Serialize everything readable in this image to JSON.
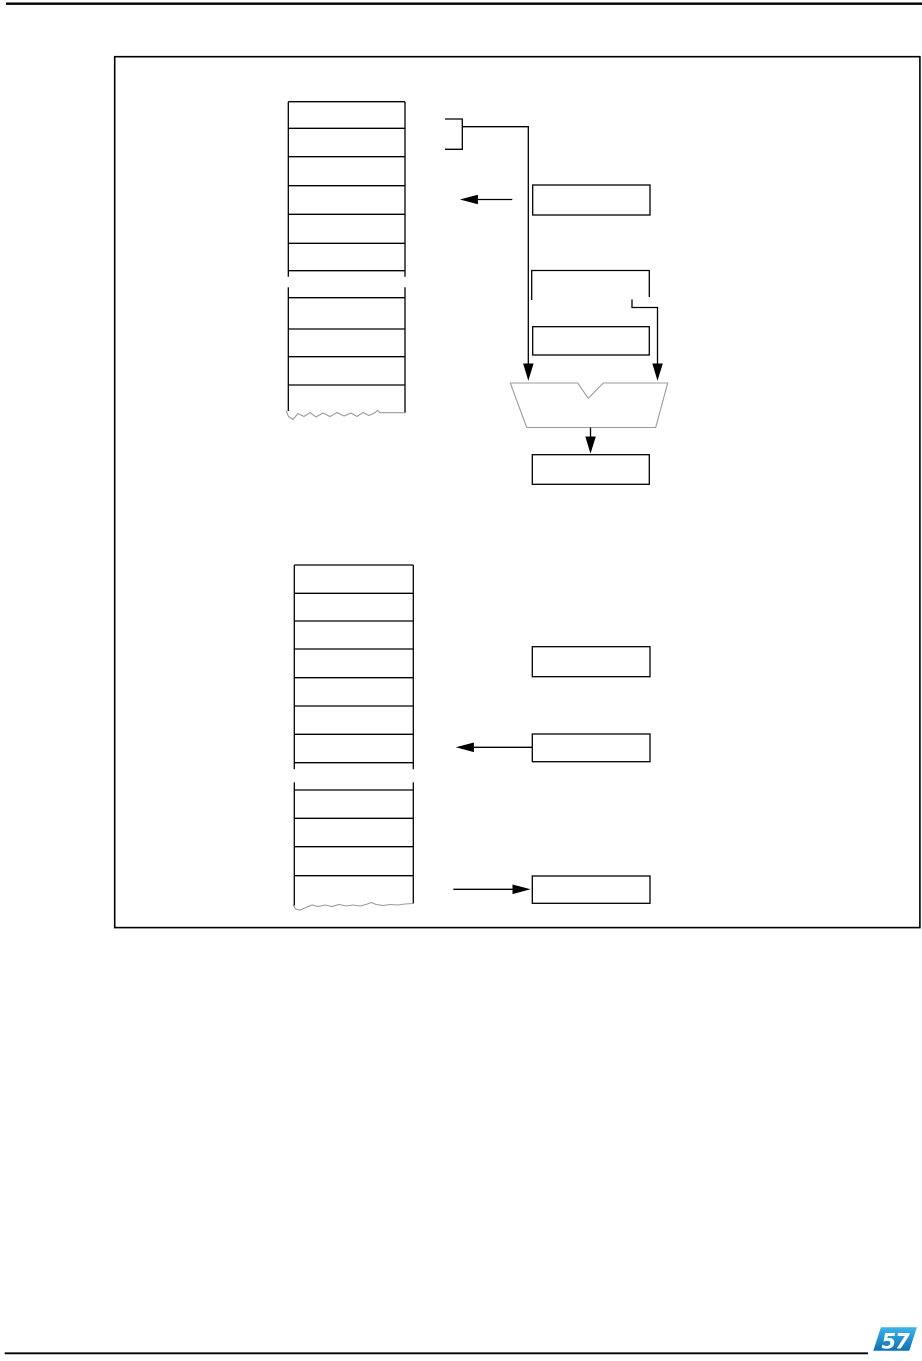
{
  "page": {
    "width": 922,
    "height": 1361,
    "background": "#ffffff"
  },
  "colors": {
    "line": "#000000",
    "soft_line": "#9b9b9b",
    "logo_top": "#3db5e9",
    "logo_bottom": "#0f6fb4",
    "logo_mark": "#ffffff"
  },
  "footer": {
    "logo": {
      "mark": "57",
      "points": "873.3,1350.7 880.9,1327.3 916.9,1327.3 909.3,1350.7",
      "gradient_top": "#3db5e9",
      "gradient_bottom": "#0f6fb4",
      "mark_x": "881.5",
      "mark_y": "1348.6"
    }
  },
  "figure": {
    "elements": [
      {
        "name": "header-rule",
        "type": "line",
        "attrs": {
          "x1": 6,
          "y1": 3.7,
          "x2": 922,
          "y2": 3.7,
          "stroke": "#000000",
          "stroke-width": 2.4
        }
      },
      {
        "name": "figure-frame",
        "type": "rect",
        "attrs": {
          "x": 114.7,
          "y": 56.7,
          "width": 805.2,
          "height": 870.9,
          "fill": "none",
          "stroke": "#000000",
          "stroke-width": 1.6
        }
      },
      {
        "name": "top-stack-left-edge-upper",
        "type": "line",
        "attrs": {
          "x1": 288.3,
          "y1": 101.7,
          "x2": 288.3,
          "y2": 276.7,
          "stroke": "#000000",
          "stroke-width": 1.3
        }
      },
      {
        "name": "top-stack-right-edge-upper",
        "type": "line",
        "attrs": {
          "x1": 405,
          "y1": 101.7,
          "x2": 405,
          "y2": 276.7,
          "stroke": "#000000",
          "stroke-width": 1.3
        }
      },
      {
        "name": "top-stack-row-line",
        "type": "line",
        "attrs": {
          "x1": 288.3,
          "y1": 101.7,
          "x2": 405,
          "y2": 101.7,
          "stroke": "#000000",
          "stroke-width": 1.3
        }
      },
      {
        "name": "top-stack-row-line",
        "type": "line",
        "attrs": {
          "x1": 288.3,
          "y1": 128.3,
          "x2": 405,
          "y2": 128.3,
          "stroke": "#000000",
          "stroke-width": 1.3
        }
      },
      {
        "name": "top-stack-row-line",
        "type": "line",
        "attrs": {
          "x1": 288.3,
          "y1": 156.7,
          "x2": 405,
          "y2": 156.7,
          "stroke": "#000000",
          "stroke-width": 1.3
        }
      },
      {
        "name": "top-stack-row-line",
        "type": "line",
        "attrs": {
          "x1": 288.3,
          "y1": 185.7,
          "x2": 405,
          "y2": 185.7,
          "stroke": "#000000",
          "stroke-width": 1.3
        }
      },
      {
        "name": "top-stack-row-line",
        "type": "line",
        "attrs": {
          "x1": 288.3,
          "y1": 214.3,
          "x2": 405,
          "y2": 214.3,
          "stroke": "#000000",
          "stroke-width": 1.3
        }
      },
      {
        "name": "top-stack-row-line",
        "type": "line",
        "attrs": {
          "x1": 288.3,
          "y1": 243.3,
          "x2": 405,
          "y2": 243.3,
          "stroke": "#000000",
          "stroke-width": 1.3
        }
      },
      {
        "name": "top-stack-row-line",
        "type": "line",
        "attrs": {
          "x1": 288.3,
          "y1": 270.7,
          "x2": 405,
          "y2": 270.7,
          "stroke": "#000000",
          "stroke-width": 1.3
        }
      },
      {
        "name": "top-stack-left-edge-lower",
        "type": "line",
        "attrs": {
          "x1": 288.3,
          "y1": 287.3,
          "x2": 288.3,
          "y2": 411,
          "stroke": "#000000",
          "stroke-width": 1.3
        }
      },
      {
        "name": "top-stack-right-edge-lower",
        "type": "line",
        "attrs": {
          "x1": 405,
          "y1": 287.3,
          "x2": 405,
          "y2": 412.5,
          "stroke": "#000000",
          "stroke-width": 1.3
        }
      },
      {
        "name": "top-stack-row-line",
        "type": "line",
        "attrs": {
          "x1": 288.3,
          "y1": 297.7,
          "x2": 405,
          "y2": 297.7,
          "stroke": "#000000",
          "stroke-width": 1.3
        }
      },
      {
        "name": "top-stack-row-line",
        "type": "line",
        "attrs": {
          "x1": 288.3,
          "y1": 329,
          "x2": 405,
          "y2": 329,
          "stroke": "#000000",
          "stroke-width": 1.3
        }
      },
      {
        "name": "top-stack-row-line",
        "type": "line",
        "attrs": {
          "x1": 288.3,
          "y1": 356.7,
          "x2": 405,
          "y2": 356.7,
          "stroke": "#000000",
          "stroke-width": 1.3
        }
      },
      {
        "name": "top-stack-row-line",
        "type": "line",
        "attrs": {
          "x1": 288.3,
          "y1": 385,
          "x2": 405,
          "y2": 385,
          "stroke": "#000000",
          "stroke-width": 1.3
        }
      },
      {
        "name": "top-stack-tear-line",
        "type": "polyline",
        "attrs": {
          "points": "286,410.5 288.5,416.5 293,419.5 298,413.5 304,416.5 310,412.5 316,417 323,413 330,416.5 337,412.5 344,416 351,413 357,416.5 363,412.5 369,415.5 375,412.7 377.5,410.5 380,412.7 406,412.7",
          "fill": "none",
          "stroke": "#9b9b9b",
          "stroke-width": 1.1
        }
      },
      {
        "name": "range-bracket",
        "type": "polyline",
        "attrs": {
          "points": "445,119 462.3,119 462.3,149.3 445,149.3",
          "fill": "none",
          "stroke": "#000000",
          "stroke-width": 1.3
        }
      },
      {
        "name": "bracket-to-alu-connector",
        "type": "polyline",
        "attrs": {
          "points": "462.3,126.7 528.3,126.7 528.3,364",
          "fill": "none",
          "stroke": "#000000",
          "stroke-width": 1.3
        }
      },
      {
        "name": "arrowhead-down-left-alu",
        "type": "polygon",
        "attrs": {
          "points": "528.3,380.7 523.1,363.5 533.6,363.5",
          "fill": "#000000",
          "stroke": "none"
        }
      },
      {
        "name": "register-box-a1",
        "type": "rect",
        "attrs": {
          "x": 532.7,
          "y": 185,
          "width": 117.3,
          "height": 30,
          "fill": "none",
          "stroke": "#000000",
          "stroke-width": 1.3
        }
      },
      {
        "name": "arrow-a1-to-stack-line",
        "type": "line",
        "attrs": {
          "x1": 477.9,
          "y1": 199.5,
          "x2": 512.3,
          "y2": 199.5,
          "stroke": "#000000",
          "stroke-width": 1.3
        }
      },
      {
        "name": "arrowhead-left-top",
        "type": "polygon",
        "attrs": {
          "points": "459.8,199.5 477.9,194.7 477.9,204.3",
          "fill": "#000000",
          "stroke": "none"
        }
      },
      {
        "name": "register-box-a2-open",
        "type": "polyline",
        "attrs": {
          "points": "531.7,300 531.7,270.5 649.3,270.5 649.3,297",
          "fill": "none",
          "stroke": "#000000",
          "stroke-width": 1.3
        }
      },
      {
        "name": "box-a2-step-connector",
        "type": "polyline",
        "attrs": {
          "points": "632,299.5 632,307.5 657.5,307.5 657.5,364",
          "fill": "none",
          "stroke": "#000000",
          "stroke-width": 1.3
        }
      },
      {
        "name": "arrowhead-down-right-alu",
        "type": "polygon",
        "attrs": {
          "points": "657.5,380.7 652.3,363.5 662.8,363.5",
          "fill": "#000000",
          "stroke": "none"
        }
      },
      {
        "name": "register-box-a3",
        "type": "rect",
        "attrs": {
          "x": 532.7,
          "y": 326.7,
          "width": 116.6,
          "height": 28.3,
          "fill": "none",
          "stroke": "#000000",
          "stroke-width": 1.3
        }
      },
      {
        "name": "alu-symbol",
        "type": "polygon",
        "attrs": {
          "points": "510.3,383 577.7,383 588.3,398.3 603.3,383 667.7,383 655.7,427.5 526.7,427.5",
          "fill": "none",
          "stroke": "#9b9b9b",
          "stroke-width": 1.1
        }
      },
      {
        "name": "alu-output-line",
        "type": "line",
        "attrs": {
          "x1": 590.5,
          "y1": 427.5,
          "x2": 590.5,
          "y2": 437.5,
          "stroke": "#000000",
          "stroke-width": 1.3
        }
      },
      {
        "name": "arrowhead-down-result",
        "type": "polygon",
        "attrs": {
          "points": "590.5,453.8 585.3,436.5 595.8,436.5",
          "fill": "#000000",
          "stroke": "none"
        }
      },
      {
        "name": "result-box",
        "type": "rect",
        "attrs": {
          "x": 532.3,
          "y": 454.7,
          "width": 117,
          "height": 29.6,
          "fill": "none",
          "stroke": "#000000",
          "stroke-width": 1.3
        }
      },
      {
        "name": "bottom-stack-left-edge-upper",
        "type": "line",
        "attrs": {
          "x1": 294.3,
          "y1": 565,
          "x2": 294.3,
          "y2": 769.3,
          "stroke": "#000000",
          "stroke-width": 1.3
        }
      },
      {
        "name": "bottom-stack-right-edge-upper",
        "type": "line",
        "attrs": {
          "x1": 413.3,
          "y1": 565,
          "x2": 413.3,
          "y2": 769.3,
          "stroke": "#000000",
          "stroke-width": 1.3
        }
      },
      {
        "name": "bottom-stack-row-line",
        "type": "line",
        "attrs": {
          "x1": 294.3,
          "y1": 565,
          "x2": 413.3,
          "y2": 565,
          "stroke": "#000000",
          "stroke-width": 1.3
        }
      },
      {
        "name": "bottom-stack-row-line",
        "type": "line",
        "attrs": {
          "x1": 294.3,
          "y1": 593.3,
          "x2": 413.3,
          "y2": 593.3,
          "stroke": "#000000",
          "stroke-width": 1.3
        }
      },
      {
        "name": "bottom-stack-row-line",
        "type": "line",
        "attrs": {
          "x1": 294.3,
          "y1": 621,
          "x2": 413.3,
          "y2": 621,
          "stroke": "#000000",
          "stroke-width": 1.3
        }
      },
      {
        "name": "bottom-stack-row-line",
        "type": "line",
        "attrs": {
          "x1": 294.3,
          "y1": 649,
          "x2": 413.3,
          "y2": 649,
          "stroke": "#000000",
          "stroke-width": 1.3
        }
      },
      {
        "name": "bottom-stack-row-line",
        "type": "line",
        "attrs": {
          "x1": 294.3,
          "y1": 677.7,
          "x2": 413.3,
          "y2": 677.7,
          "stroke": "#000000",
          "stroke-width": 1.3
        }
      },
      {
        "name": "bottom-stack-row-line",
        "type": "line",
        "attrs": {
          "x1": 294.3,
          "y1": 706,
          "x2": 413.3,
          "y2": 706,
          "stroke": "#000000",
          "stroke-width": 1.3
        }
      },
      {
        "name": "bottom-stack-row-line",
        "type": "line",
        "attrs": {
          "x1": 294.3,
          "y1": 734.3,
          "x2": 413.3,
          "y2": 734.3,
          "stroke": "#000000",
          "stroke-width": 1.3
        }
      },
      {
        "name": "bottom-stack-row-line",
        "type": "line",
        "attrs": {
          "x1": 294.3,
          "y1": 762.7,
          "x2": 413.3,
          "y2": 762.7,
          "stroke": "#000000",
          "stroke-width": 1.3
        }
      },
      {
        "name": "bottom-stack-left-edge-lower",
        "type": "line",
        "attrs": {
          "x1": 294.3,
          "y1": 782.3,
          "x2": 294.3,
          "y2": 905.5,
          "stroke": "#000000",
          "stroke-width": 1.3
        }
      },
      {
        "name": "bottom-stack-right-edge-lower",
        "type": "line",
        "attrs": {
          "x1": 413.3,
          "y1": 782.3,
          "x2": 413.3,
          "y2": 903.5,
          "stroke": "#000000",
          "stroke-width": 1.3
        }
      },
      {
        "name": "bottom-stack-row-line",
        "type": "line",
        "attrs": {
          "x1": 294.3,
          "y1": 790,
          "x2": 413.3,
          "y2": 790,
          "stroke": "#000000",
          "stroke-width": 1.3
        }
      },
      {
        "name": "bottom-stack-row-line",
        "type": "line",
        "attrs": {
          "x1": 294.3,
          "y1": 818.3,
          "x2": 413.3,
          "y2": 818.3,
          "stroke": "#000000",
          "stroke-width": 1.3
        }
      },
      {
        "name": "bottom-stack-row-line",
        "type": "line",
        "attrs": {
          "x1": 294.3,
          "y1": 846.7,
          "x2": 413.3,
          "y2": 846.7,
          "stroke": "#000000",
          "stroke-width": 1.3
        }
      },
      {
        "name": "bottom-stack-row-line",
        "type": "line",
        "attrs": {
          "x1": 294.3,
          "y1": 875.7,
          "x2": 413.3,
          "y2": 875.7,
          "stroke": "#000000",
          "stroke-width": 1.3
        }
      },
      {
        "name": "bottom-stack-tear-line",
        "type": "polyline",
        "attrs": {
          "points": "293,904.5 295.5,909 300,910 306,907.5 312,905 318,906.5 325,905 332,906.5 339,904.5 346,906 353,905 360,906 366,904.5 371.5,902.5 376,904.5 383,905.5 390,904.5 398,905 405,904 413,903.5",
          "fill": "none",
          "stroke": "#9b9b9b",
          "stroke-width": 1.1
        }
      },
      {
        "name": "register-box-b1",
        "type": "rect",
        "attrs": {
          "x": 532.3,
          "y": 646.7,
          "width": 117.7,
          "height": 30,
          "fill": "none",
          "stroke": "#000000",
          "stroke-width": 1.3
        }
      },
      {
        "name": "register-box-b2",
        "type": "rect",
        "attrs": {
          "x": 532.3,
          "y": 734,
          "width": 117.7,
          "height": 27.7,
          "fill": "none",
          "stroke": "#000000",
          "stroke-width": 1.3
        }
      },
      {
        "name": "arrow-b2-to-stack-line",
        "type": "line",
        "attrs": {
          "x1": 473.9,
          "y1": 747.3,
          "x2": 532.3,
          "y2": 747.3,
          "stroke": "#000000",
          "stroke-width": 1.3
        }
      },
      {
        "name": "arrowhead-left-bottom",
        "type": "polygon",
        "attrs": {
          "points": "455.8,747.3 473.9,742.5 473.9,752.1",
          "fill": "#000000",
          "stroke": "none"
        }
      },
      {
        "name": "register-box-b3",
        "type": "rect",
        "attrs": {
          "x": 532.3,
          "y": 876,
          "width": 117.7,
          "height": 27.3,
          "fill": "none",
          "stroke": "#000000",
          "stroke-width": 1.3
        }
      },
      {
        "name": "arrow-stack-to-b3-line",
        "type": "line",
        "attrs": {
          "x1": 453.3,
          "y1": 889.3,
          "x2": 512.5,
          "y2": 889.3,
          "stroke": "#000000",
          "stroke-width": 1.3
        }
      },
      {
        "name": "arrowhead-right-bottom",
        "type": "polygon",
        "attrs": {
          "points": "530.6,889.3 512.5,884.5 512.5,894.1",
          "fill": "#000000",
          "stroke": "none"
        }
      },
      {
        "name": "footer-rule",
        "type": "line",
        "attrs": {
          "x1": 4.7,
          "y1": 1353.3,
          "x2": 868,
          "y2": 1353.3,
          "stroke": "#000000",
          "stroke-width": 1.8
        }
      }
    ]
  }
}
